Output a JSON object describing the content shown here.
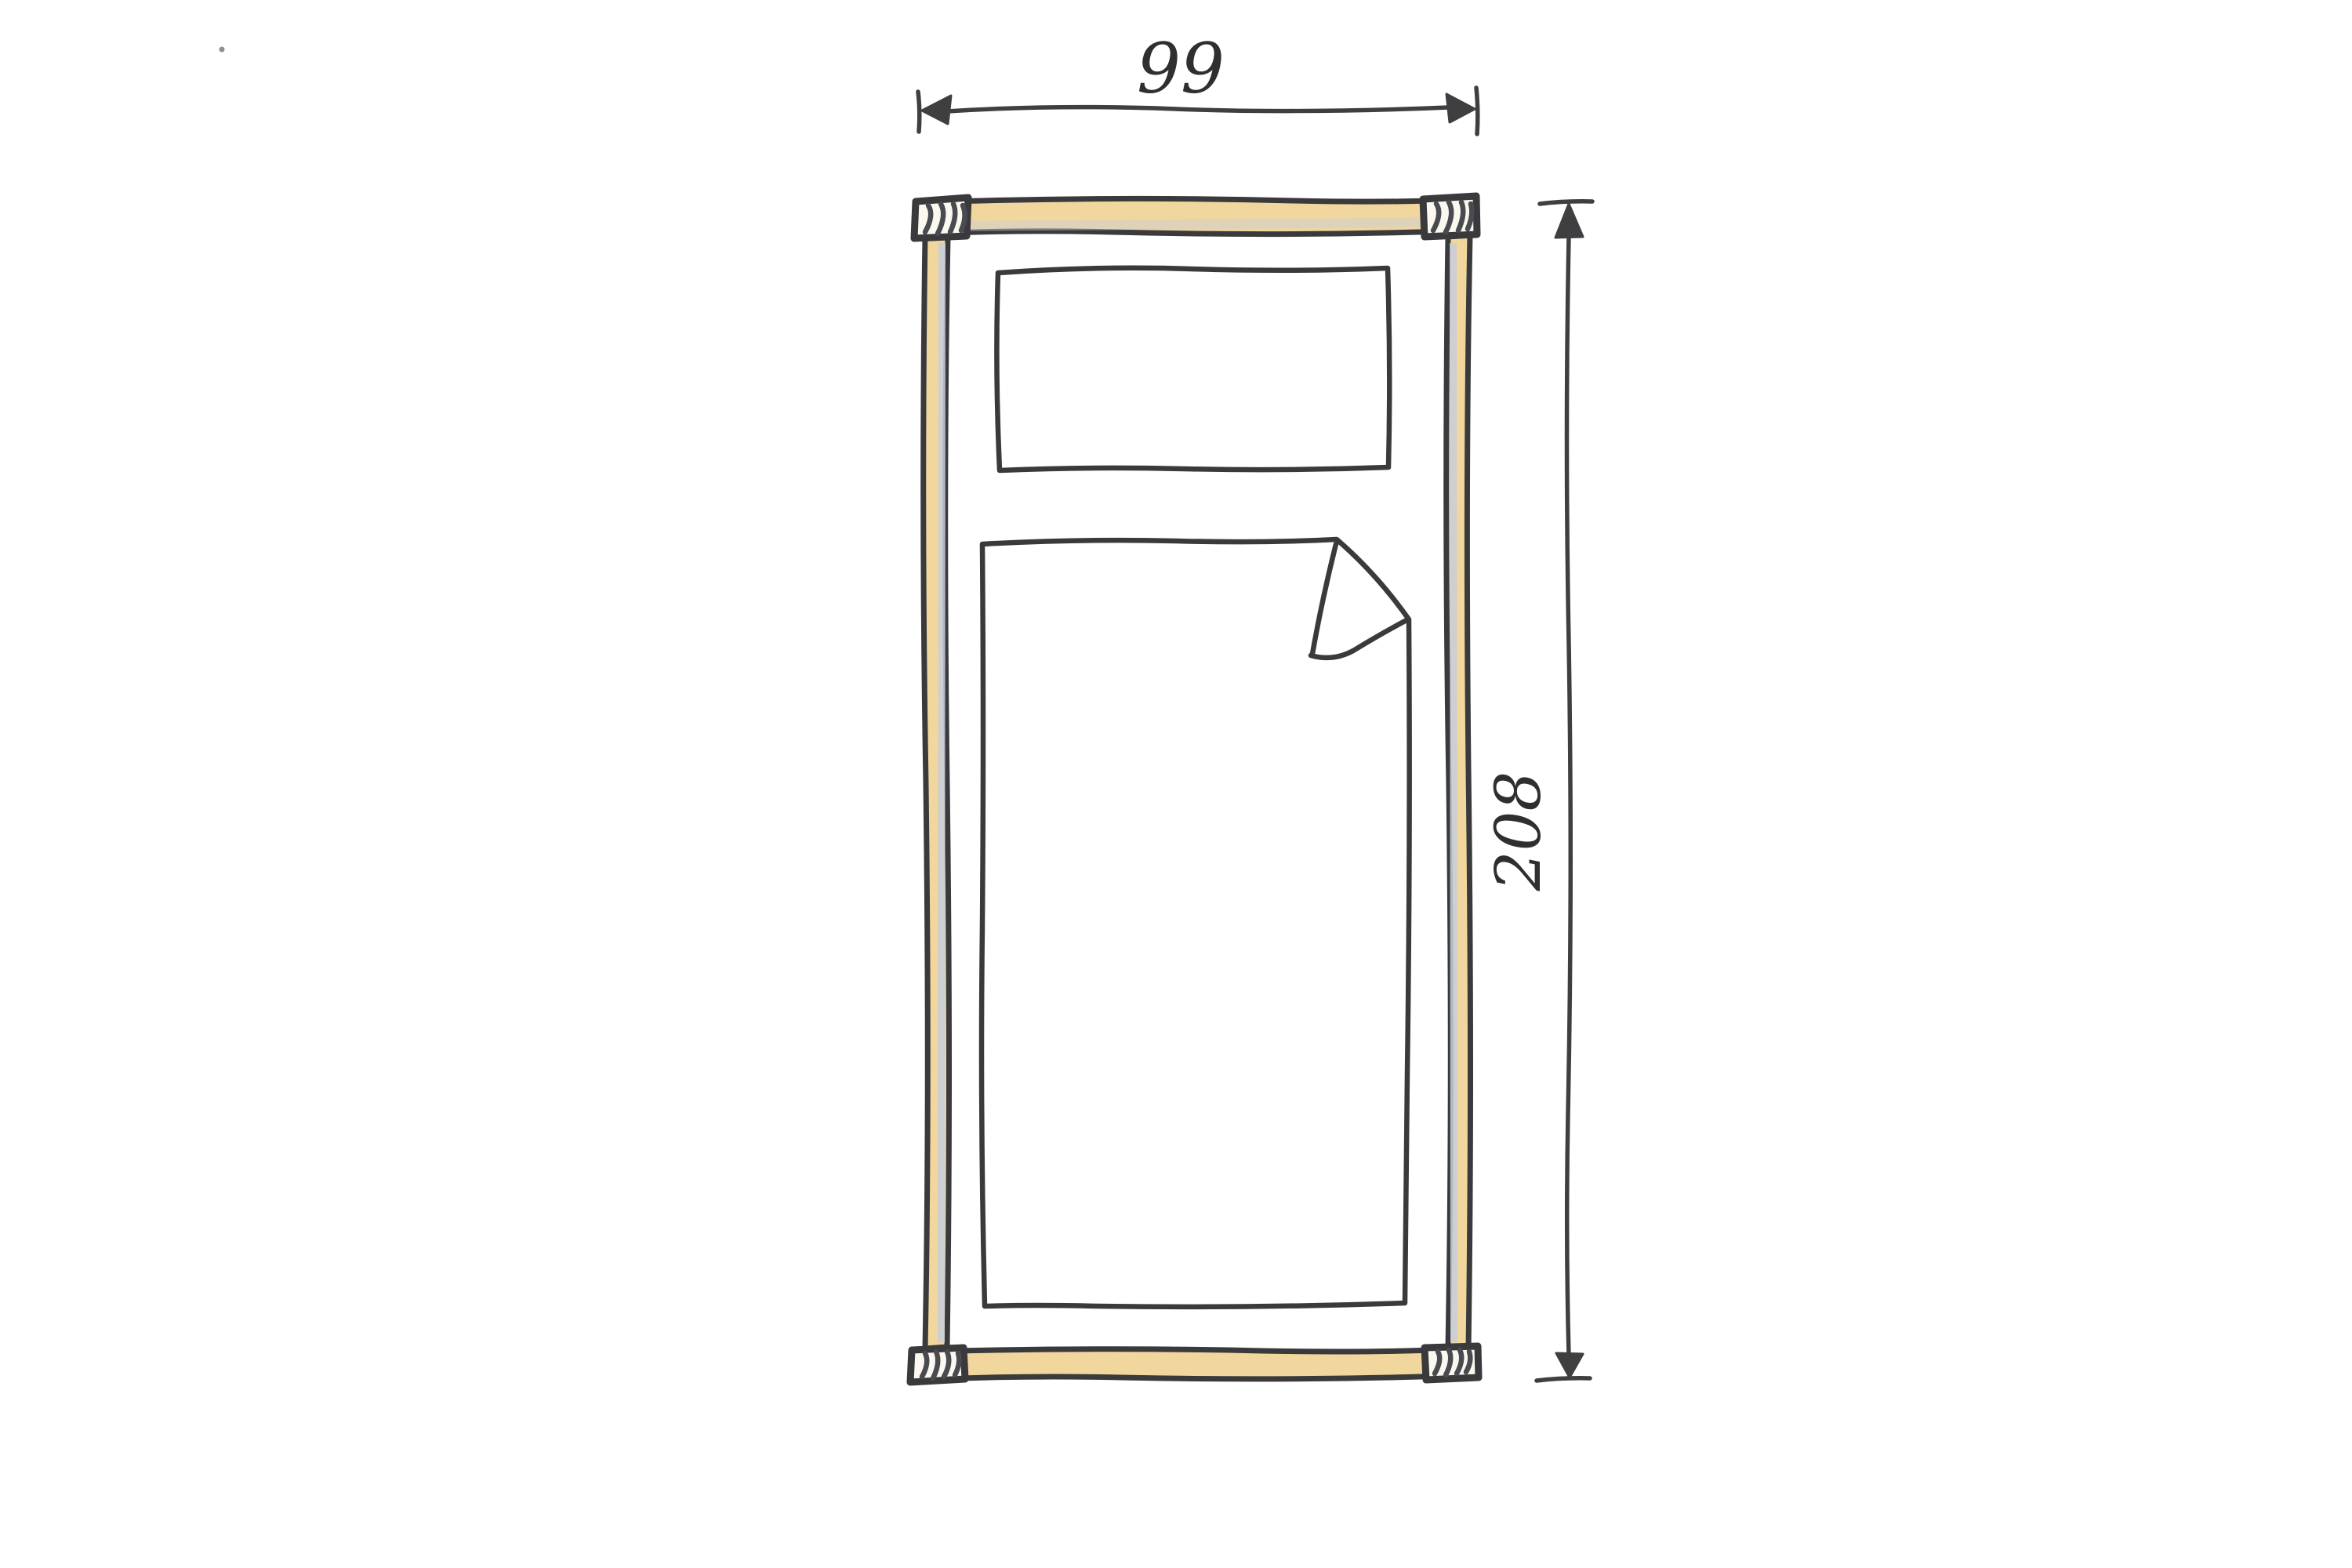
{
  "dimensions": {
    "width_label": "99",
    "height_label": "208"
  },
  "colors": {
    "background": "#FFFFFF",
    "wood_fill": "#F1D79E",
    "post_fill": "#FBF8F0",
    "shadow_stripe": "#C7CEDA",
    "bedding_fill": "#FFFFFF",
    "ink": "#3A3A3C",
    "dimension_ink": "#3F3F41",
    "label_ink": "#2F2F31"
  }
}
